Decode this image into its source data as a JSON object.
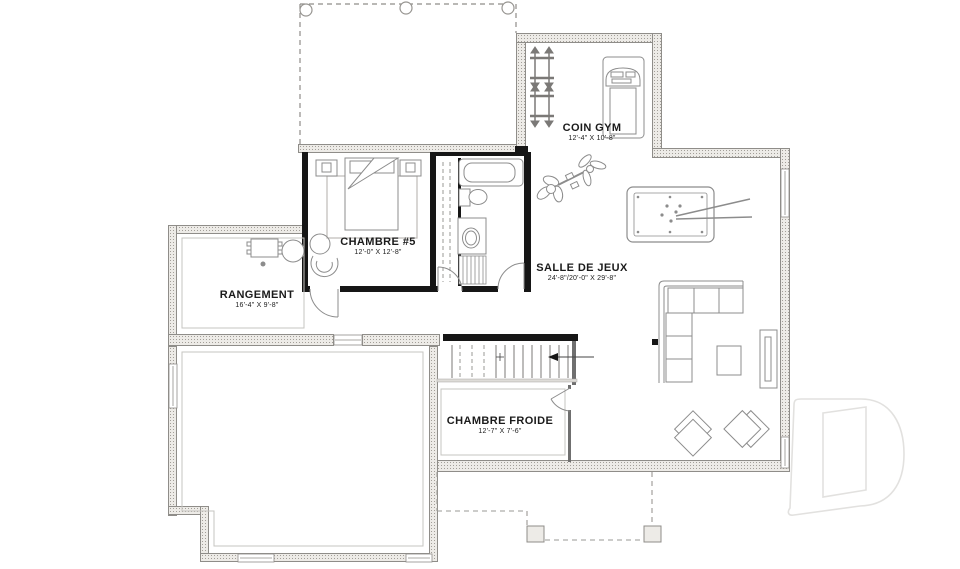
{
  "plan": {
    "rooms": [
      {
        "id": "coin-gym",
        "name": "COIN GYM",
        "dims": "12'-4\" X 10'-8\""
      },
      {
        "id": "chambre-5",
        "name": "CHAMBRE #5",
        "dims": "12'-0\" X 12'-8\""
      },
      {
        "id": "rangement",
        "name": "RANGEMENT",
        "dims": "16'-4\" X 9'-8\""
      },
      {
        "id": "salle-de-jeux",
        "name": "SALLE DE JEUX",
        "dims": "24'-8\"/20'-0\" X 29'-8\""
      },
      {
        "id": "chambre-froide",
        "name": "CHAMBRE FROIDE",
        "dims": "12'-7\" X 7'-6\""
      }
    ],
    "watermark_letter": "D",
    "colors": {
      "wall_fill": "#edebe7",
      "wall_stipple": "#a29e98",
      "wall_black": "#161616",
      "line": "#8c8c8c",
      "watermark": "#e2e1df"
    }
  }
}
